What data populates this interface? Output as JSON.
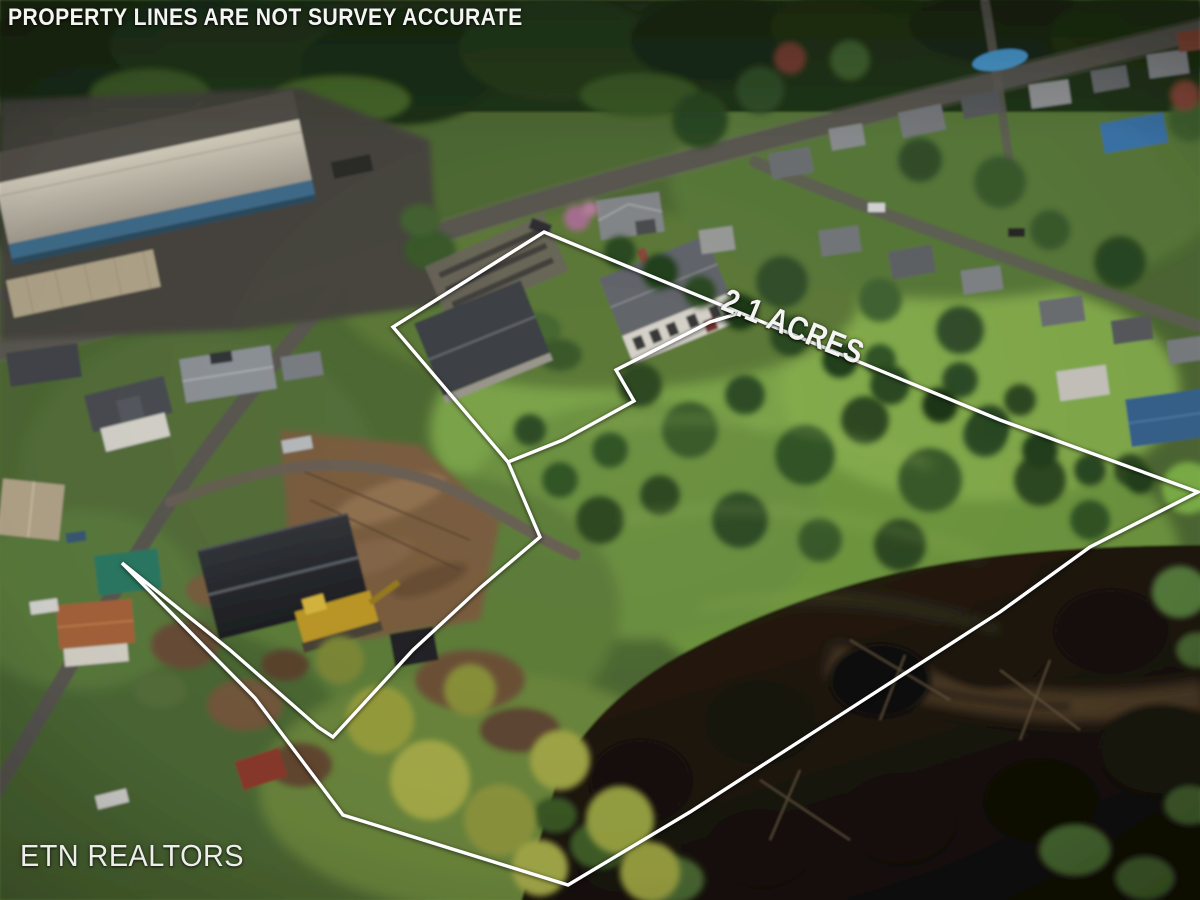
{
  "overlays": {
    "disclaimer": "PROPERTY LINES ARE NOT SURVEY ACCURATE",
    "acreage": "2.1 ACRES",
    "brand": "ETN REALTORS"
  },
  "boundary": {
    "color": "#ffffff",
    "main_path": "M544,232 L1000,420 L1198,492 L1090,547 L1000,612 L690,812 L568,885 L343,815 L255,698 L122,563 L230,650 L318,727 L333,737 L413,650 L480,588 L540,537 L508,462 L393,327 Z",
    "notch_path": "M508,462 L563,440 L634,401 L616,370 L710,322 L740,313"
  }
}
